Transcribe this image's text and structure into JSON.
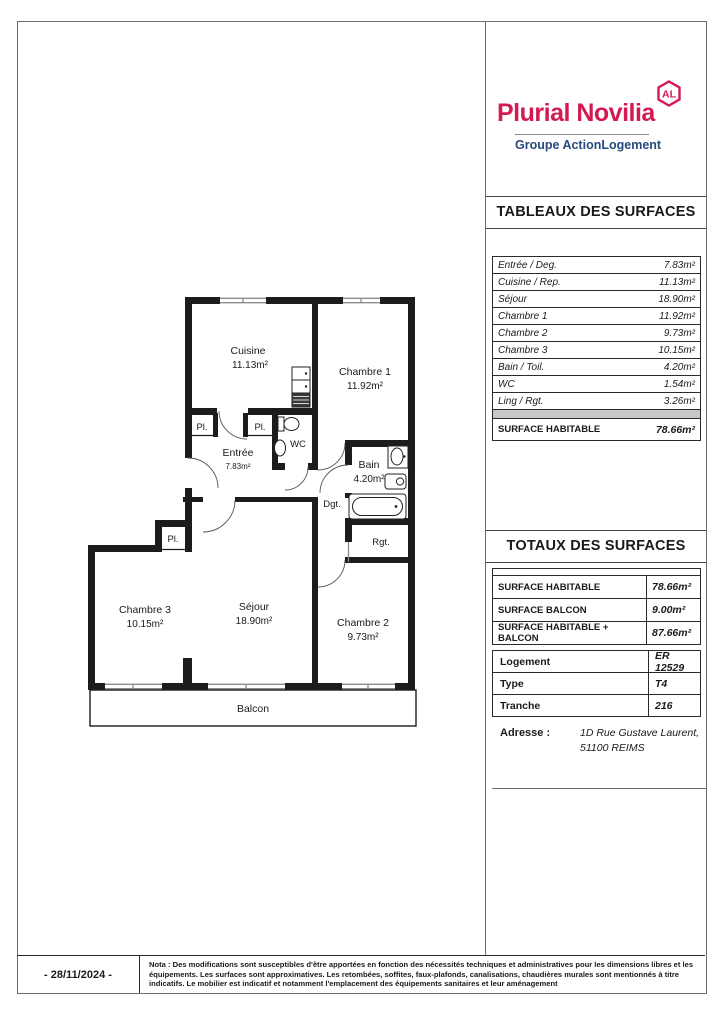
{
  "logo": {
    "brand": "Plurial Novilia",
    "badge": "AL",
    "subtitle": "Groupe ActionLogement",
    "brand_color": "#d31a52",
    "subtitle_color": "#27497b"
  },
  "surfaces": {
    "title": "TABLEAUX DES SURFACES",
    "rows": [
      {
        "label": "Entrée / Deg.",
        "value": "7.83m²"
      },
      {
        "label": "Cuisine / Rep.",
        "value": "11.13m²"
      },
      {
        "label": "Séjour",
        "value": "18.90m²"
      },
      {
        "label": "Chambre 1",
        "value": "11.92m²"
      },
      {
        "label": "Chambre 2",
        "value": "9.73m²"
      },
      {
        "label": "Chambre 3",
        "value": "10.15m²"
      },
      {
        "label": "Bain / Toil.",
        "value": "4.20m²"
      },
      {
        "label": "WC",
        "value": "1.54m²"
      },
      {
        "label": "Ling / Rgt.",
        "value": "3.26m²"
      }
    ],
    "total": {
      "label": "SURFACE HABITABLE",
      "value": "78.66m²"
    }
  },
  "totaux": {
    "title": "TOTAUX DES SURFACES",
    "rows": [
      {
        "label": "SURFACE HABITABLE",
        "value": "78.66m²"
      },
      {
        "label": "SURFACE BALCON",
        "value": "9.00m²"
      },
      {
        "label": "SURFACE HABITABLE + BALCON",
        "value": "87.66m²"
      }
    ]
  },
  "info": {
    "rows": [
      {
        "label": "Logement",
        "value": "ER 12529"
      },
      {
        "label": "Type",
        "value": "T4"
      },
      {
        "label": "Tranche",
        "value": "216"
      }
    ]
  },
  "adresse": {
    "label": "Adresse :",
    "line1": "1D Rue Gustave Laurent,",
    "line2": "51100 REIMS"
  },
  "footer": {
    "date": "- 28/11/2024 -",
    "note": "Nota : Des modifications sont susceptibles d'être apportées en fonction des nécessités techniques et administratives pour les dimensions libres et les équipements. Les surfaces sont approximatives. Les retombées, soffites, faux-plafonds, canalisations, chaudières murales sont mentionnés à titre indicatifs. Le mobilier est indicatif et notamment l'emplacement des équipements sanitaires et leur aménagement"
  },
  "floor_plan": {
    "rooms": {
      "cuisine": {
        "name": "Cuisine",
        "area": "11.13m²"
      },
      "chambre1": {
        "name": "Chambre 1",
        "area": "11.92m²"
      },
      "entree": {
        "name": "Entrée",
        "area": "7.83m²"
      },
      "wc": {
        "name": "WC"
      },
      "bain": {
        "name": "Bain",
        "area": "4.20m²"
      },
      "dgt": {
        "name": "Dgt."
      },
      "rgt": {
        "name": "Rgt."
      },
      "chambre3": {
        "name": "Chambre 3",
        "area": "10.15m²"
      },
      "sejour": {
        "name": "Séjour",
        "area": "18.90m²"
      },
      "chambre2": {
        "name": "Chambre 2",
        "area": "9.73m²"
      }
    },
    "closet_label": "Pl.",
    "balcony": "Balcon"
  }
}
